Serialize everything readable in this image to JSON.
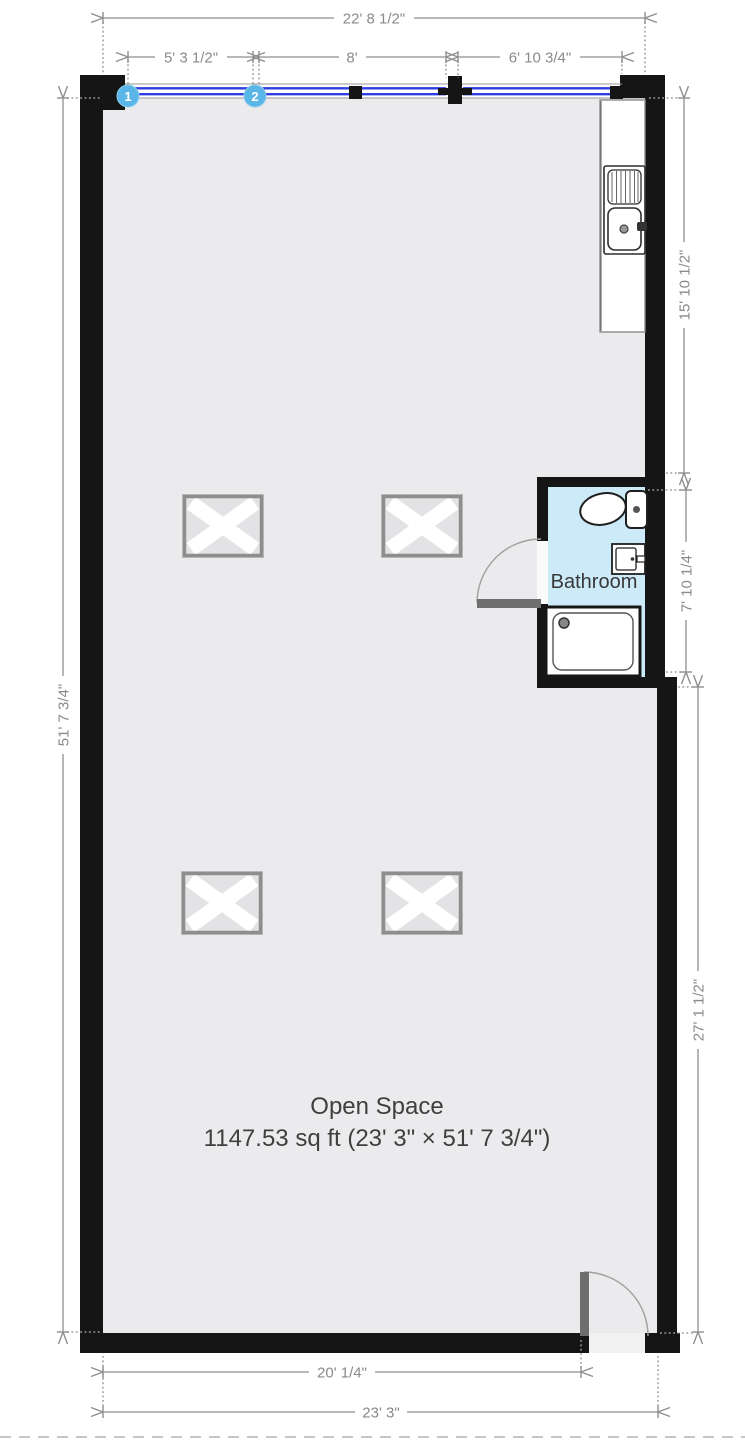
{
  "plan": {
    "rooms": {
      "open_space": {
        "name": "Open Space",
        "area": "1147.53 sq ft (23' 3\" × 51' 7 3/4\")"
      },
      "bathroom": {
        "name": "Bathroom"
      }
    },
    "window_markers": {
      "marker_1": "1",
      "marker_2": "2"
    },
    "dimensions": {
      "top_total": "22' 8 1/2\"",
      "window_1": "5' 3 1/2\"",
      "window_2": "8'",
      "window_3": "6' 10 3/4\"",
      "left_total": "51' 7 3/4\"",
      "right_upper": "15' 10 1/2\"",
      "right_bathroom": "7' 10 1/4\"",
      "right_lower": "27' 1 1/2\"",
      "bottom_inner": "20' 1/4\"",
      "bottom_total": "23' 3\""
    },
    "fixtures": {
      "kitchen_sink": "kitchen-sink",
      "toilet": "toilet",
      "bathroom_sink": "bathroom-vanity-sink",
      "shower": "shower-tray",
      "skylight": "ceiling-light"
    },
    "colors": {
      "wall": "#151515",
      "floor": "#ebebed",
      "bathroom_floor": "#cdeaf9",
      "window_blue": "#2e3ee5",
      "marker_blue": "#5bb6e8",
      "dimension_gray": "#8f8f8f",
      "door_gray": "#6e6e6e"
    }
  }
}
